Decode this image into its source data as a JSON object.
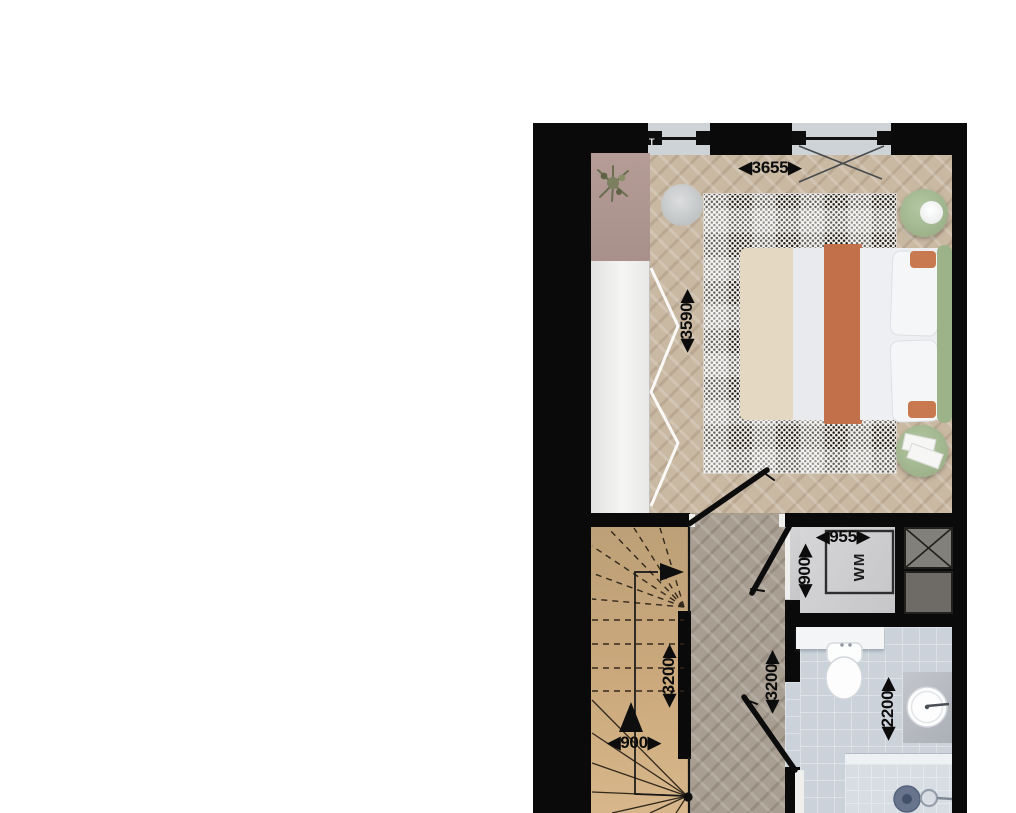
{
  "view": {
    "type": "architectural floor plan, top-down furnished"
  },
  "dims": {
    "bedroom_width": {
      "value": "3655",
      "display": "◀3655▶",
      "orientation": "horizontal"
    },
    "bedroom_depth": {
      "value": "3590",
      "display": "◀3590▶",
      "orientation": "vertical"
    },
    "wm_closet_width": {
      "value": "955",
      "display": "◀955▶",
      "orientation": "horizontal"
    },
    "wm_closet_depth": {
      "value": "900",
      "display": "◀900▶",
      "orientation": "vertical"
    },
    "stair_run": {
      "value": "3200",
      "display": "◀3200▶",
      "orientation": "vertical"
    },
    "hall_run": {
      "value": "3200",
      "display": "◀3200▶",
      "orientation": "vertical"
    },
    "stair_width": {
      "value": "900",
      "display": "◀900▶",
      "orientation": "horizontal"
    },
    "bathroom_depth": {
      "value": "2200",
      "display": "◀2200▶",
      "orientation": "vertical"
    }
  },
  "labels": {
    "washing_machine": "WM",
    "window_tag": "T"
  },
  "colors": {
    "wall": "#0a0a0a",
    "bedroom_floor": "#c9b8a2",
    "hall_floor": "#a89e92",
    "stair": "#caa87c",
    "wm_floor": "#d3d3d5",
    "bathroom_tile": "#cbd2da",
    "rug": "#f2efe9",
    "bed_orange": "#c2704a",
    "bed_beige": "#e5d8c2",
    "headboard_green": "#9cb289",
    "table_green": "#a8bd97",
    "cabinet_mauve": "#b29792",
    "wardrobe_white": "#f0f0ef"
  }
}
